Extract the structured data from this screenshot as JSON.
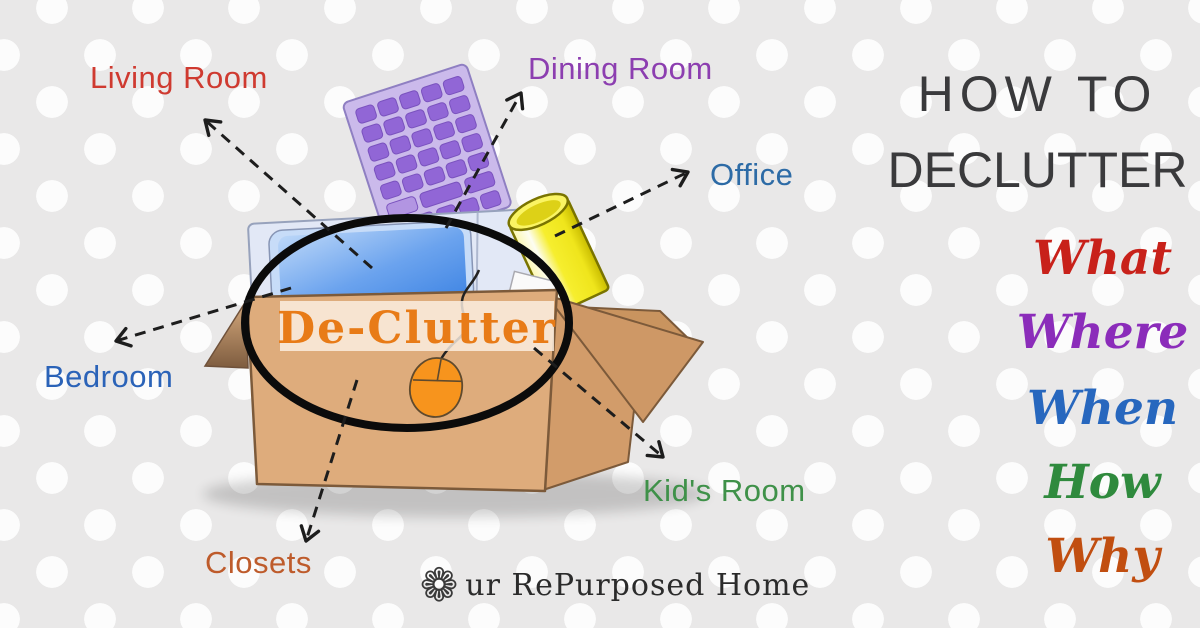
{
  "background": {
    "base_color": "#e9e8e8",
    "dot_color": "#fcfcfc"
  },
  "headline": {
    "line1": "HOW TO",
    "line2": "DECLUTTER",
    "color": "#3a3a3c"
  },
  "question_words": [
    {
      "label": "What",
      "color": "#c8211a"
    },
    {
      "label": "Where",
      "color": "#8b2cba"
    },
    {
      "label": "When",
      "color": "#2767be"
    },
    {
      "label": "How",
      "color": "#2f8a3d"
    },
    {
      "label": "Why",
      "color": "#c14e10"
    }
  ],
  "diagram": {
    "center_label": {
      "text": "De-Clutter",
      "color": "#e87b17"
    },
    "rooms": [
      {
        "label": "Living Room",
        "color": "#cf3a30"
      },
      {
        "label": "Dining Room",
        "color": "#8c3eb0"
      },
      {
        "label": "Office",
        "color": "#2d6ba6"
      },
      {
        "label": "Bedroom",
        "color": "#2b63b8"
      },
      {
        "label": "Kid's Room",
        "color": "#3f9149"
      },
      {
        "label": "Closets",
        "color": "#be5b2b"
      }
    ],
    "illustration_items": [
      "cardboard box",
      "purple keyboard",
      "monitor",
      "yellow cup",
      "orange mouse"
    ]
  },
  "logo": {
    "flower_icon": "❁",
    "text": "ur RePurposed Home"
  }
}
